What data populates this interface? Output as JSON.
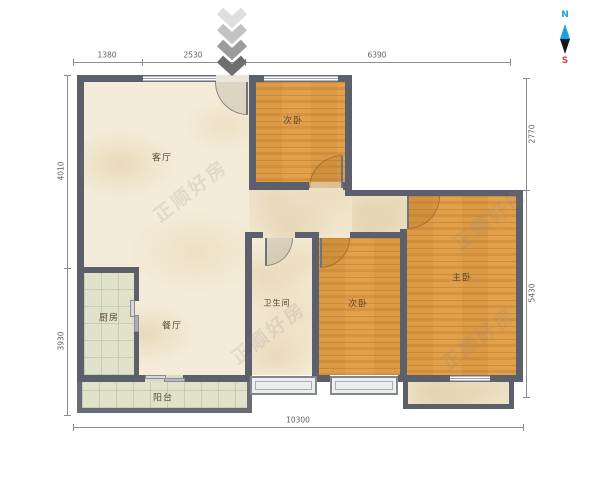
{
  "watermark": "正顺好房",
  "compass": {
    "north": "N",
    "south": "S"
  },
  "rooms": {
    "living": {
      "label": "客厅"
    },
    "dining": {
      "label": "餐厅"
    },
    "kitchen": {
      "label": "厨房"
    },
    "bathroom": {
      "label": "卫生间"
    },
    "bedroom_top": {
      "label": "次卧"
    },
    "bedroom_mid": {
      "label": "次卧"
    },
    "master": {
      "label": "主卧"
    },
    "balcony": {
      "label": "阳台"
    }
  },
  "dimensions": {
    "top": [
      {
        "value": "1380"
      },
      {
        "value": "2530"
      },
      {
        "value": "6390"
      }
    ],
    "left": [
      {
        "value": "4010"
      },
      {
        "value": "3930"
      }
    ],
    "right": [
      {
        "value": "2770"
      },
      {
        "value": "5430"
      }
    ],
    "bottom": [
      {
        "value": "10300"
      }
    ]
  },
  "colors": {
    "wall": "#5c606a",
    "wood_floor": "#e3a04a",
    "tile_floor": "#e0e3ca",
    "marble_floor": "#f4ecd9",
    "compass_north": "#17a2e3",
    "compass_south": "#c8473d"
  }
}
